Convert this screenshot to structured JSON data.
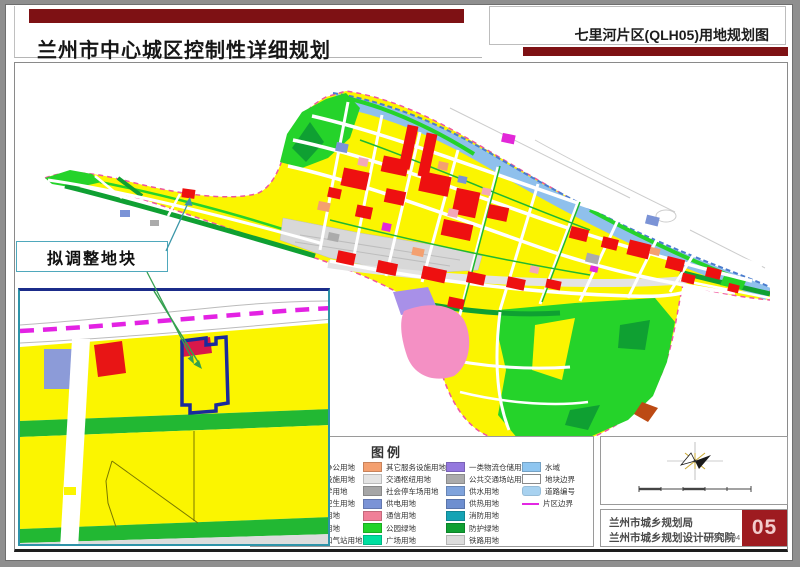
{
  "header": {
    "accent_color": "#7e1114",
    "main_title": "兰州市中心城区控制性详细规划",
    "sub_title": "七里河片区(QLH05)用地规划图"
  },
  "callout": {
    "label": "拟调整地块"
  },
  "legend": {
    "title": "图例",
    "col1": [
      {
        "label": "行政办公用地",
        "color": "#e87272"
      },
      {
        "label": "文化设施用地",
        "color": "#f08cb4"
      },
      {
        "label": "中小学用地",
        "color": "#ffb3c8"
      },
      {
        "label": "医疗卫生用地",
        "color": "#ec8080"
      },
      {
        "label": "商业用地",
        "color": "#f02020"
      },
      {
        "label": "商务用地",
        "color": "#d81616"
      },
      {
        "label": "加油加气站用地",
        "color": "#b56a32"
      }
    ],
    "col2": [
      {
        "label": "其它服务设施用地",
        "color": "#f4a070"
      },
      {
        "label": "交通枢纽用地",
        "color": "#e4e4e4"
      },
      {
        "label": "社会停车场用地",
        "color": "#a6a6a6"
      },
      {
        "label": "供电用地",
        "color": "#7b93d6"
      },
      {
        "label": "通信用地",
        "color": "#f08098"
      },
      {
        "label": "公园绿地",
        "color": "#21d42a"
      },
      {
        "label": "广场用地",
        "color": "#00dfa0"
      }
    ],
    "col3": [
      {
        "label": "一类物流仓储用地",
        "color": "#9478de"
      },
      {
        "label": "公共交通场站用地",
        "color": "#ababab"
      },
      {
        "label": "供水用地",
        "color": "#7fa3dc"
      },
      {
        "label": "供热用地",
        "color": "#6e8fd0"
      },
      {
        "label": "消防用地",
        "color": "#15a3b4"
      },
      {
        "label": "防护绿地",
        "color": "#0fa032"
      },
      {
        "label": "铁路用地",
        "color": "#dcdcdc"
      }
    ],
    "col4": [
      {
        "label": "水域",
        "color": "#8fc6f0"
      },
      {
        "label": "地块边界",
        "color": "#ffffff"
      },
      {
        "label": "道路编号",
        "color": "#a8d2f0"
      },
      {
        "label": "片区边界",
        "color": "#e327e3"
      }
    ]
  },
  "map": {
    "residential_yellow": "#fbf500",
    "river_blue": "#8fc0ec",
    "boundary_pink": "#f0559e",
    "inset_boundary_magenta": "#e322e3",
    "adjust_plot_outline": "#1a2a9c"
  },
  "footer": {
    "org_line1": "兰州市城乡规划局",
    "org_line2": "兰州市城乡规划设计研究院",
    "date": "2018.04",
    "page_number": "05",
    "page_box_color": "#9e1b20"
  }
}
